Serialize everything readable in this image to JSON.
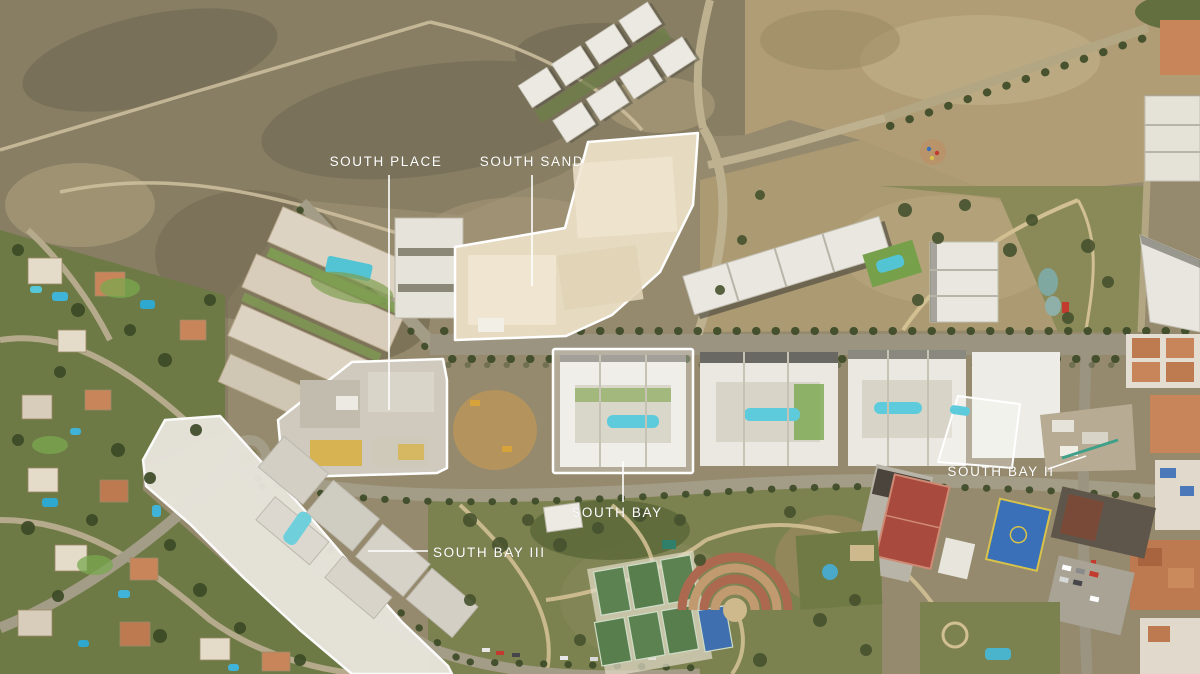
{
  "map": {
    "type": "annotated aerial drone photograph of a residential masterplan",
    "labels": [
      {
        "id": "south-place",
        "text": "SOUTH PLACE"
      },
      {
        "id": "south-sand",
        "text": "SOUTH SAND"
      },
      {
        "id": "south-bay",
        "text": "SOUTH BAY"
      },
      {
        "id": "south-bay-ii",
        "text": "SOUTH BAY II"
      },
      {
        "id": "south-bay-iii",
        "text": "SOUTH BAY III"
      }
    ],
    "colors": {
      "label_text": "#ffffff",
      "zone_outline": "#ffffff",
      "pool_water": "#56c6d8",
      "scrubland": "#877e63",
      "dirt": "#b09d76",
      "park_green": "#7c8150",
      "road": "#a09a85",
      "building_white": "#ebe9e2",
      "roof_orange": "#bf7b50",
      "court_red": "#a84a3e",
      "court_blue": "#3a70b8"
    }
  }
}
